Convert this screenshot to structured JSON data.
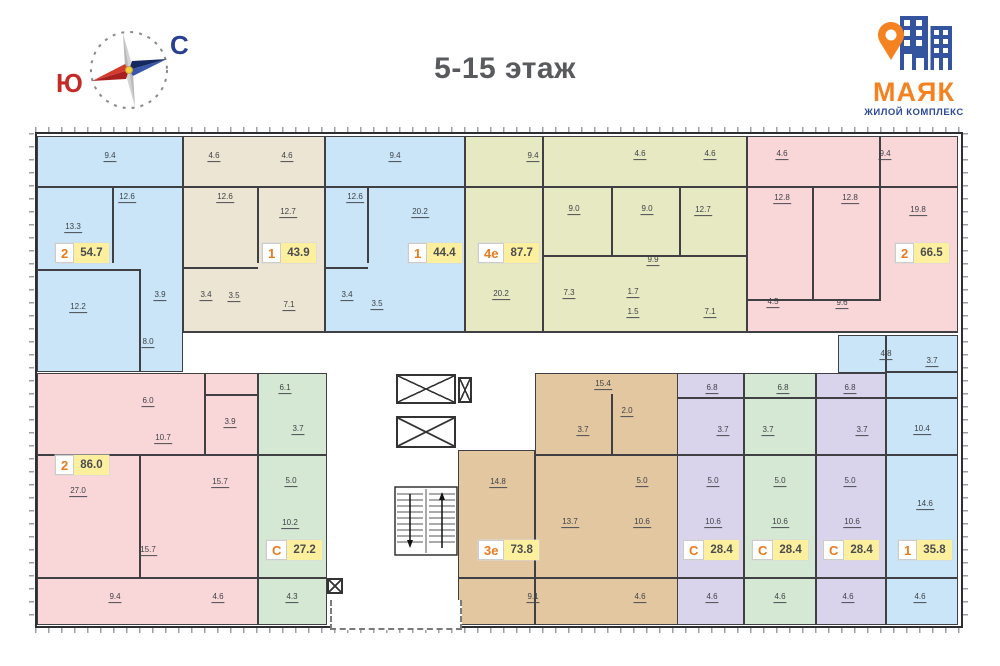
{
  "header": {
    "title": "5-15 этаж",
    "compass": {
      "south_label": "Ю",
      "north_label": "С"
    },
    "logo": {
      "name": "МАЯК",
      "subtitle": "ЖИЛОЙ КОМПЛЕКС"
    }
  },
  "plan": {
    "badge_style": {
      "type_color": "#e87b1e",
      "area_bg": "#fcf09e",
      "area_color": "#4c4c50"
    },
    "apartments": [
      {
        "id": "apt-2-54.7",
        "type": "2",
        "area": "54.7",
        "color": "#c9e5f7",
        "badge": [
          55,
          243
        ],
        "regions": [
          [
            37,
            136,
            183,
            372
          ]
        ],
        "rooms": [
          [
            "9.4",
            110,
            157
          ],
          [
            "12.6",
            127,
            198
          ],
          [
            "13.3",
            73,
            228
          ],
          [
            "12.2",
            78,
            308
          ],
          [
            "3.9",
            160,
            296
          ],
          [
            "8.0",
            148,
            343
          ]
        ]
      },
      {
        "id": "apt-1-43.9",
        "type": "1",
        "area": "43.9",
        "color": "#ece5d3",
        "badge": [
          262,
          243
        ],
        "regions": [
          [
            183,
            136,
            325,
            333
          ]
        ],
        "rooms": [
          [
            "4.6",
            214,
            157
          ],
          [
            "4.6",
            287,
            157
          ],
          [
            "12.6",
            225,
            198
          ],
          [
            "12.7",
            288,
            213
          ],
          [
            "3.4",
            206,
            296
          ],
          [
            "3.5",
            234,
            297
          ],
          [
            "7.1",
            289,
            306
          ]
        ]
      },
      {
        "id": "apt-1-44.4",
        "type": "1",
        "area": "44.4",
        "color": "#c9e5f7",
        "badge": [
          408,
          243
        ],
        "regions": [
          [
            325,
            136,
            465,
            333
          ]
        ],
        "rooms": [
          [
            "9.4",
            395,
            157
          ],
          [
            "12.6",
            355,
            198
          ],
          [
            "20.2",
            420,
            213
          ],
          [
            "3.4",
            347,
            296
          ],
          [
            "3.5",
            377,
            305
          ]
        ]
      },
      {
        "id": "apt-4e-87.7",
        "type": "4е",
        "area": "87.7",
        "color": "#e6e9c2",
        "badge": [
          478,
          243
        ],
        "regions": [
          [
            465,
            136,
            747,
            333
          ]
        ],
        "rooms": [
          [
            "9.4",
            533,
            157
          ],
          [
            "4.6",
            640,
            155
          ],
          [
            "4.6",
            710,
            155
          ],
          [
            "9.0",
            574,
            210
          ],
          [
            "9.0",
            647,
            210
          ],
          [
            "12.7",
            703,
            211
          ],
          [
            "9.9",
            653,
            261
          ],
          [
            "20.2",
            501,
            295
          ],
          [
            "7.3",
            569,
            294
          ],
          [
            "1.7",
            633,
            293
          ],
          [
            "1.5",
            633,
            313
          ],
          [
            "7.1",
            710,
            313
          ]
        ]
      },
      {
        "id": "apt-2-66.5",
        "type": "2",
        "area": "66.5",
        "color": "#f9d6d8",
        "badge": [
          895,
          243
        ],
        "regions": [
          [
            747,
            136,
            958,
            333
          ]
        ],
        "rooms": [
          [
            "4.6",
            782,
            155
          ],
          [
            "9.4",
            885,
            155
          ],
          [
            "12.8",
            782,
            199
          ],
          [
            "12.8",
            850,
            199
          ],
          [
            "19.8",
            918,
            211
          ],
          [
            "4.5",
            773,
            303
          ],
          [
            "9.6",
            842,
            304
          ]
        ]
      },
      {
        "id": "apt-2-86.0",
        "type": "2",
        "area": "86.0",
        "color": "#f9d6d8",
        "badge": [
          55,
          455
        ],
        "regions": [
          [
            37,
            373,
            258,
            625
          ]
        ],
        "rooms": [
          [
            "6.0",
            148,
            402
          ],
          [
            "10.7",
            163,
            439
          ],
          [
            "3.9",
            230,
            423
          ],
          [
            "27.0",
            78,
            492
          ],
          [
            "15.7",
            220,
            483
          ],
          [
            "15.7",
            148,
            551
          ],
          [
            "9.4",
            115,
            598
          ],
          [
            "4.6",
            218,
            598
          ]
        ]
      },
      {
        "id": "apt-s-27.2",
        "type": "С",
        "area": "27.2",
        "color": "#d5e8d3",
        "badge": [
          266,
          540
        ],
        "regions": [
          [
            258,
            373,
            327,
            625
          ]
        ],
        "rooms": [
          [
            "6.1",
            285,
            389
          ],
          [
            "3.7",
            298,
            430
          ],
          [
            "5.0",
            291,
            482
          ],
          [
            "10.2",
            290,
            524
          ],
          [
            "4.3",
            292,
            598
          ]
        ]
      },
      {
        "id": "apt-3e-73.8",
        "type": "3е",
        "area": "73.8",
        "color": "#e3c7a0",
        "badge": [
          478,
          540
        ],
        "regions": [
          [
            535,
            373,
            680,
            625
          ],
          [
            458,
            450,
            535,
            625
          ]
        ],
        "rooms": [
          [
            "15.4",
            603,
            385
          ],
          [
            "2.0",
            627,
            412
          ],
          [
            "3.7",
            583,
            431
          ],
          [
            "14.8",
            498,
            483
          ],
          [
            "5.0",
            642,
            482
          ],
          [
            "13.7",
            570,
            523
          ],
          [
            "10.6",
            642,
            523
          ],
          [
            "9.1",
            533,
            598
          ],
          [
            "4.6",
            640,
            598
          ]
        ]
      },
      {
        "id": "apt-s-28.4-a",
        "type": "С",
        "area": "28.4",
        "color": "#d9d4ec",
        "badge": [
          683,
          540
        ],
        "regions": [
          [
            677,
            373,
            744,
            625
          ]
        ],
        "rooms": [
          [
            "6.8",
            712,
            389
          ],
          [
            "3.7",
            723,
            431
          ],
          [
            "5.0",
            713,
            482
          ],
          [
            "10.6",
            713,
            523
          ],
          [
            "4.6",
            712,
            598
          ]
        ]
      },
      {
        "id": "apt-s-28.4-b",
        "type": "С",
        "area": "28.4",
        "color": "#d5e8d3",
        "badge": [
          752,
          540
        ],
        "regions": [
          [
            744,
            373,
            816,
            625
          ]
        ],
        "rooms": [
          [
            "6.8",
            783,
            389
          ],
          [
            "3.7",
            768,
            431
          ],
          [
            "5.0",
            780,
            482
          ],
          [
            "10.6",
            780,
            523
          ],
          [
            "4.6",
            780,
            598
          ]
        ]
      },
      {
        "id": "apt-s-28.4-c",
        "type": "С",
        "area": "28.4",
        "color": "#d9d4ec",
        "badge": [
          823,
          540
        ],
        "regions": [
          [
            816,
            373,
            886,
            625
          ]
        ],
        "rooms": [
          [
            "6.8",
            850,
            389
          ],
          [
            "3.7",
            862,
            431
          ],
          [
            "5.0",
            850,
            482
          ],
          [
            "10.6",
            852,
            523
          ],
          [
            "4.6",
            848,
            598
          ]
        ]
      },
      {
        "id": "apt-1-35.8",
        "type": "1",
        "area": "35.8",
        "color": "#c9e5f7",
        "badge": [
          898,
          540
        ],
        "regions": [
          [
            886,
            335,
            958,
            625
          ],
          [
            838,
            335,
            886,
            373
          ]
        ],
        "rooms": [
          [
            "4.8",
            886,
            355
          ],
          [
            "3.7",
            932,
            362
          ],
          [
            "10.4",
            922,
            430
          ],
          [
            "14.6",
            925,
            505
          ],
          [
            "4.6",
            920,
            598
          ]
        ]
      }
    ],
    "walls": [
      [
        37,
        186,
        921,
        2
      ],
      [
        37,
        577,
        290,
        2
      ],
      [
        458,
        577,
        500,
        2
      ],
      [
        183,
        331,
        775,
        2
      ],
      [
        112,
        187,
        2,
        76
      ],
      [
        37,
        269,
        104,
        2
      ],
      [
        139,
        269,
        2,
        103
      ],
      [
        257,
        187,
        2,
        76
      ],
      [
        183,
        267,
        75,
        2
      ],
      [
        367,
        187,
        2,
        76
      ],
      [
        325,
        267,
        43,
        2
      ],
      [
        542,
        136,
        2,
        196
      ],
      [
        611,
        187,
        2,
        70
      ],
      [
        679,
        187,
        2,
        70
      ],
      [
        542,
        255,
        205,
        2
      ],
      [
        812,
        187,
        2,
        114
      ],
      [
        879,
        136,
        2,
        165
      ],
      [
        747,
        299,
        133,
        2
      ],
      [
        37,
        454,
        221,
        2
      ],
      [
        139,
        454,
        2,
        124
      ],
      [
        204,
        373,
        2,
        82
      ],
      [
        204,
        394,
        54,
        2
      ],
      [
        258,
        454,
        69,
        2
      ],
      [
        611,
        394,
        2,
        62
      ],
      [
        535,
        454,
        145,
        2
      ],
      [
        677,
        397,
        281,
        2
      ],
      [
        677,
        454,
        281,
        2
      ],
      [
        886,
        371,
        72,
        2
      ]
    ]
  }
}
